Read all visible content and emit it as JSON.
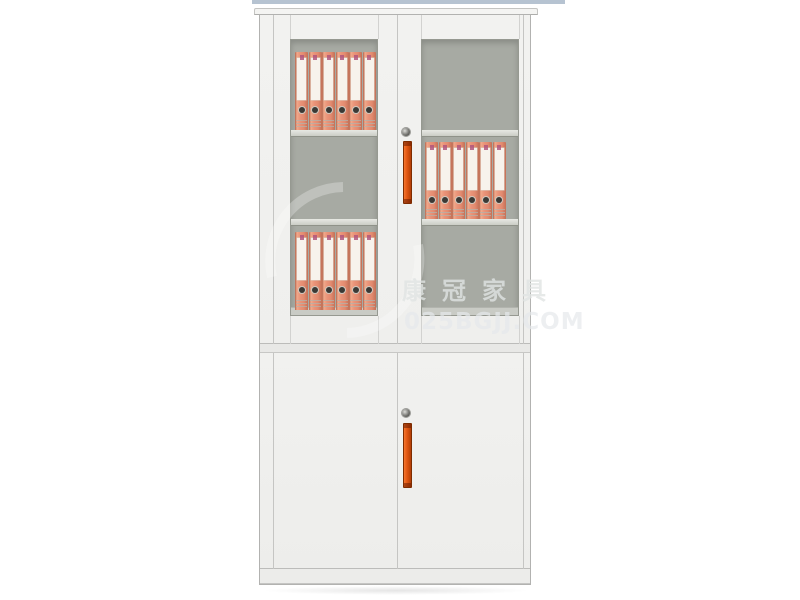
{
  "image": {
    "description": "Product photo of a two-section white steel office filing cabinet with framed glass upper doors, orange lever-arch binders on interior shelves, solid lower doors, vertical orange handles and round keyholes",
    "background": "#ffffff"
  },
  "watermark": {
    "brand": "康冠家具",
    "url": "025BGJJ.COM"
  },
  "colors": {
    "strip_blue": "#b6c3d1",
    "cabinet_white": "#f0f0ee",
    "glass_gray": "#a7aaa3",
    "binder_salmon": "#e28a6f",
    "accent_orange": "#e05612"
  },
  "cabinet": {
    "sections": [
      "upper-glass-doors",
      "lower-solid-doors"
    ],
    "shelves_per_glass_door": 3,
    "locks": 2,
    "handles": 2,
    "binder_rows": [
      {
        "window": "left",
        "level": 1,
        "count": 6,
        "top": 12,
        "height": 78,
        "left": 4
      },
      {
        "window": "right",
        "level": 2,
        "count": 6,
        "top": 102,
        "height": 77,
        "left": 3
      },
      {
        "window": "left",
        "level": 3,
        "count": 6,
        "top": 192,
        "height": 78,
        "left": 4
      }
    ]
  }
}
